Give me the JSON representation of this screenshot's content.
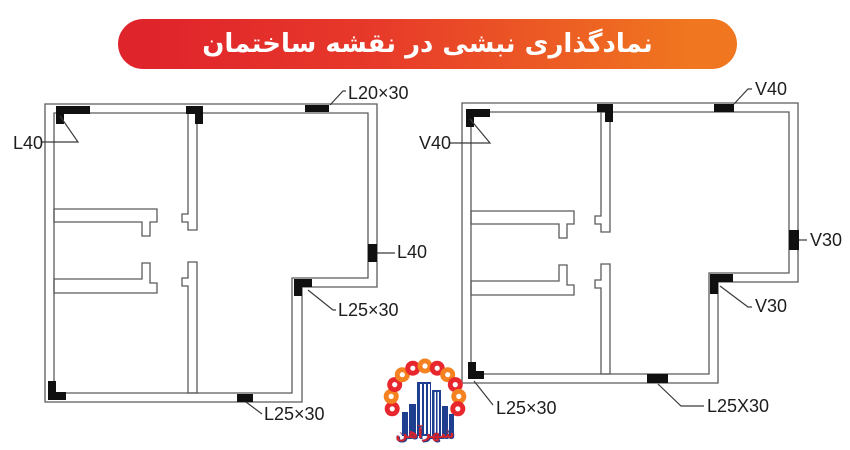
{
  "title": {
    "text": "نمادگذاری نبشی در نقشه ساختمان"
  },
  "plans": {
    "left": {
      "labels": {
        "top_wall": "L20×30",
        "top_left_corner": "L40",
        "right_wall": "L40",
        "notch_corner": "L25×30",
        "bottom_wall": "L25×30"
      }
    },
    "right": {
      "labels": {
        "top_wall": "V40",
        "top_left_corner": "V40",
        "right_wall": "V30",
        "notch_corner": "V30",
        "bottom_left_corner": "L25×30",
        "bottom_wall": "L25X30"
      }
    }
  },
  "logo": {
    "text": "شهرآهن"
  },
  "colors": {
    "banner_red": "#e0242b",
    "banner_orange": "#f0761f",
    "wall_line": "#5a5a5a",
    "marker_black": "#101010",
    "label_text": "#1d1d1d",
    "logo_orange": "#f58220",
    "logo_red": "#e8262d",
    "logo_blue": "#1e3f8f"
  }
}
